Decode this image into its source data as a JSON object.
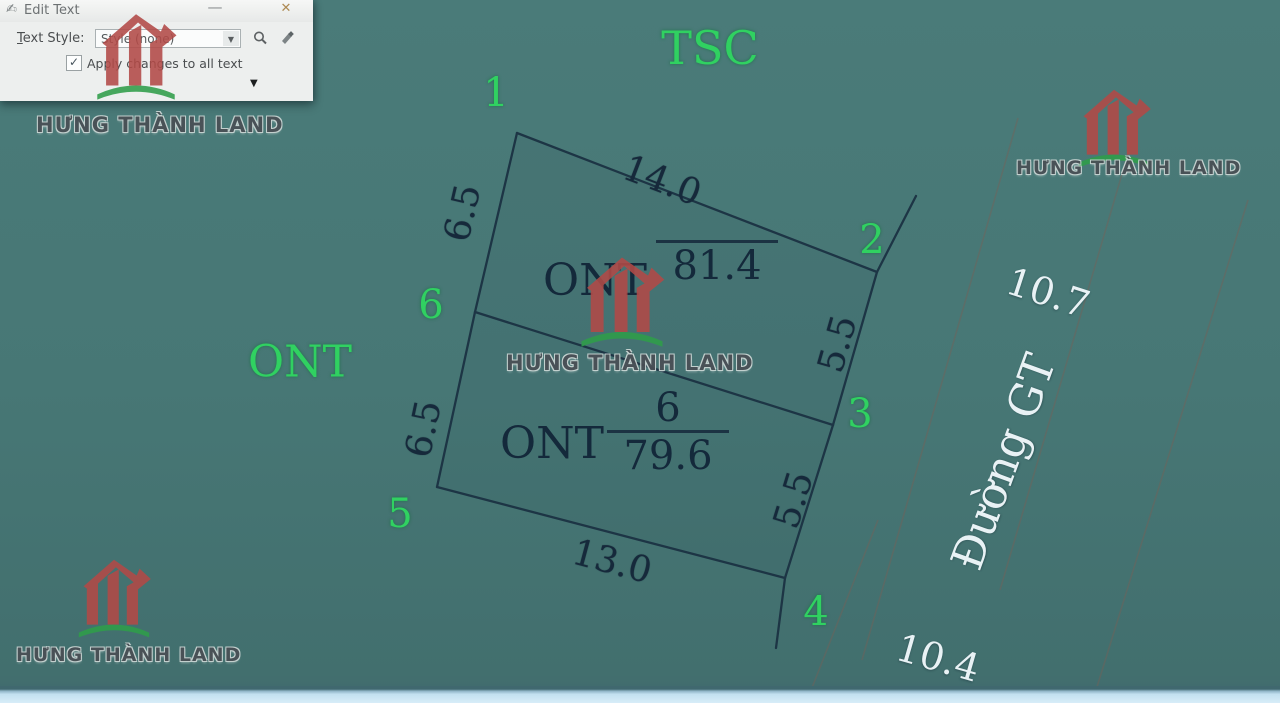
{
  "dialog": {
    "title": "Edit Text",
    "minimize": "—",
    "close": "✕",
    "text_style_initial": "T",
    "text_style_rest": "ext Style:",
    "style_value": "Style (none)",
    "apply_label": "Apply changes to all text",
    "checkbox_check": "✓",
    "combo_arrow": "▼",
    "expander": "▼"
  },
  "watermark": {
    "brand": "HƯNG THÀNH LAND"
  },
  "map": {
    "zone_label_top": "TSC",
    "zone_label_left": "ONT",
    "road_name": "Đường GT",
    "corners": [
      "1",
      "2",
      "3",
      "4",
      "5",
      "6"
    ],
    "parcels": [
      {
        "land_type": "ONT",
        "lot_number": "",
        "area": "81.4"
      },
      {
        "land_type": "ONT",
        "lot_number": "6",
        "area": "79.6"
      }
    ],
    "dimensions": {
      "top": "14.0",
      "left_upper": "6.5",
      "left_lower": "6.5",
      "right_upper": "5.5",
      "right_lower": "5.5",
      "bottom": "13.0",
      "road_width_upper": "10.7",
      "road_width_lower": "10.4"
    },
    "colors": {
      "background": "#477775",
      "boundary_line": "#1d3545",
      "dimension_text": "#16293b",
      "corner_text": "#30d161",
      "road_text": "#e9f2f5",
      "logo_red": "#b24a47",
      "logo_green": "#2f9e4a",
      "bottom_bar": "#cfe7f4"
    }
  }
}
